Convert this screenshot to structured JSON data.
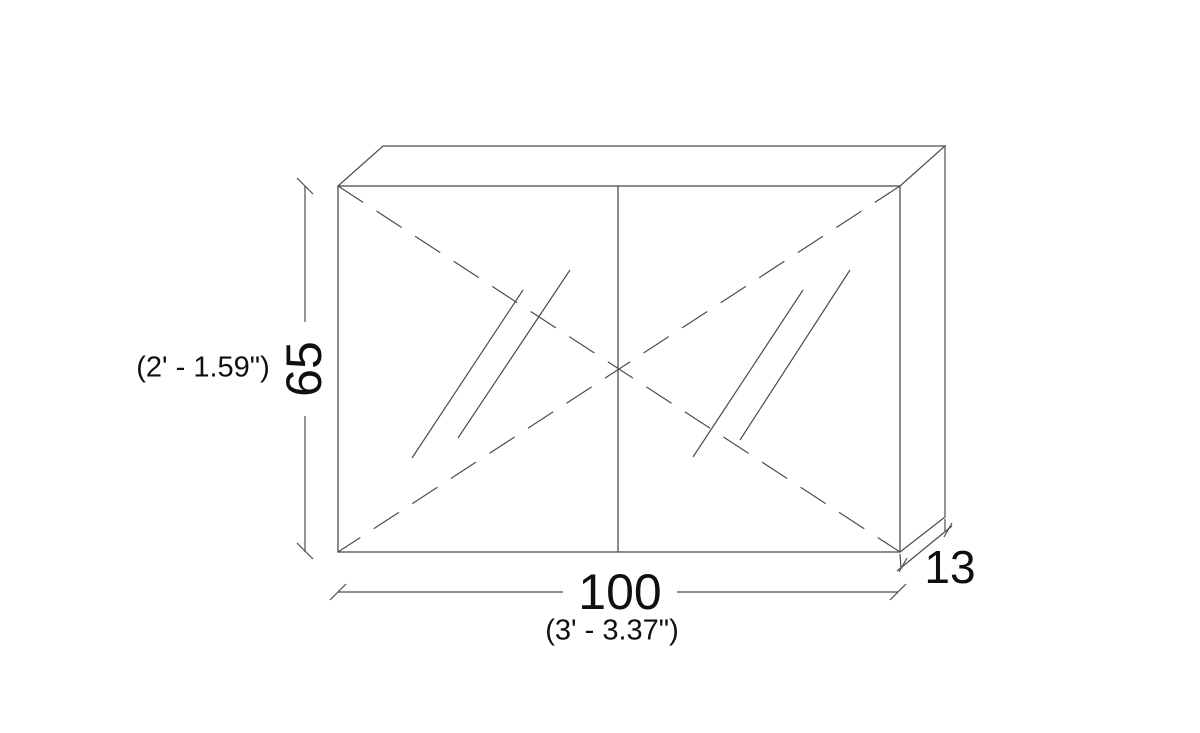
{
  "drawing": {
    "type": "cad-elevation",
    "subject": "double-door mirrored cabinet with top and side faces shown in oblique projection",
    "background_color": "#ffffff",
    "line_color": "#4d4d4d",
    "text_color": "#0f0f0f"
  },
  "labels": {
    "height_value": "65",
    "height_imperial": "(2' - 1.59\")",
    "width_value": "100",
    "width_imperial": "(3' - 3.37\")",
    "depth_value": "13"
  },
  "dimensions": {
    "width": {
      "value": 100,
      "imperial": "3' - 3.37\""
    },
    "height": {
      "value": 65,
      "imperial": "2' - 1.59\""
    },
    "depth": {
      "value": 13
    }
  }
}
